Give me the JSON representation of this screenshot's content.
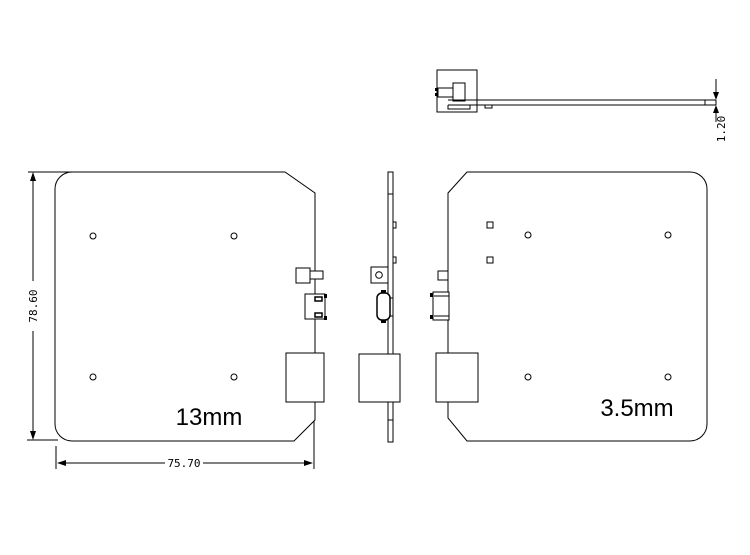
{
  "drawing": {
    "background_color": "#ffffff",
    "line_color": "#000000",
    "views": {
      "top_profile": {
        "thickness_dimension": "1.20"
      },
      "plate_13mm": {
        "label": "13mm",
        "height_dimension": "78.60",
        "width_dimension": "75.70"
      },
      "plate_3_5mm": {
        "label": "3.5mm"
      }
    }
  }
}
